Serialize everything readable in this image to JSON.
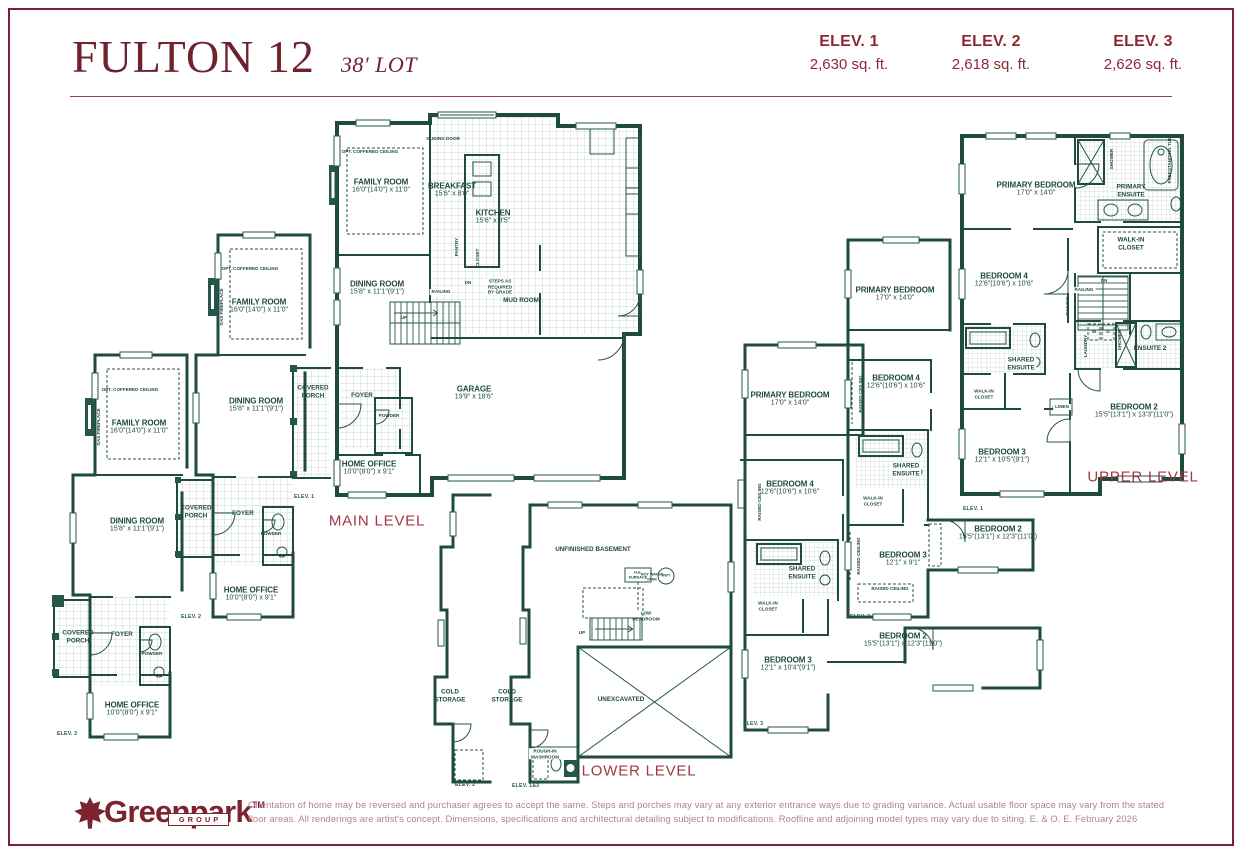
{
  "header": {
    "title": "FULTON 12",
    "lot": "38' LOT"
  },
  "elevations": [
    {
      "label": "ELEV. 1",
      "area": "2,630 sq. ft."
    },
    {
      "label": "ELEV. 2",
      "area": "2,618 sq. ft."
    },
    {
      "label": "ELEV. 3",
      "area": "2,626 sq. ft."
    }
  ],
  "levels": {
    "main": "MAIN LEVEL",
    "lower": "LOWER LEVEL",
    "upper": "UPPER LEVEL"
  },
  "rooms": {
    "family": {
      "name": "FAMILY ROOM",
      "dim": "16'0\"(14'0\") x 11'0\""
    },
    "breakfast": {
      "name": "BREAKFAST",
      "dim": "15'6\" x 8'0\""
    },
    "kitchen": {
      "name": "KITCHEN",
      "dim": "15'6\" x 8'5\""
    },
    "dining": {
      "name": "DINING ROOM",
      "dim": "15'8\" x 11'1\"(9'1\")"
    },
    "garage": {
      "name": "GARAGE",
      "dim": "19'9\" x 18'6\""
    },
    "home_office": {
      "name": "HOME OFFICE",
      "dim": "10'0\"(8'0\") x 9'1\""
    },
    "primary": {
      "name": "PRIMARY BEDROOM",
      "dim": "17'0\" x 14'0\""
    },
    "bedroom4": {
      "name": "BEDROOM 4",
      "dim": "12'6\"(10'6\") x 10'6\""
    },
    "bedroom3_e1": {
      "name": "BEDROOM 3",
      "dim": "12'1\" x 10'5\"(9'1\")"
    },
    "bedroom3_e2": {
      "name": "BEDROOM 3",
      "dim": "12'1\" x 9'1\""
    },
    "bedroom3_e3": {
      "name": "BEDROOM 3",
      "dim": "12'1\" x 10'4\"(9'1\")"
    },
    "bedroom2_e1": {
      "name": "BEDROOM 2",
      "dim": "15'5\"(13'1\") x 13'3\"(11'0\")"
    },
    "bedroom2_e23": {
      "name": "BEDROOM 2",
      "dim": "15'5\"(13'1\") x 12'3\"(11'0\")"
    }
  },
  "labels": {
    "covered_porch": "COVERED\nPORCH",
    "foyer": "FOYER",
    "powder": "POWDER",
    "mud_room": "MUD ROOM",
    "pantry": "PANTRY",
    "closet": "CLOSET",
    "sliding_door": "SLIDING DOOR",
    "opt_coffered": "OPT. COFFERED CEILING",
    "gas_fireplace": "GAS FIREPLACE",
    "railing": "RAILING",
    "up": "UP",
    "dn": "DN",
    "steps_grade": "STEPS AS\nREQUIRED\nBY GRADE",
    "unfinished": "UNFINISHED BASEMENT",
    "cold_storage": "COLD\nSTORAGE",
    "unexcavated": "UNEXCAVATED",
    "he_furnace": "H.E.\nFURNACE",
    "hot_water": "HOT WATER\nTANK",
    "hwt": "HWT",
    "low_headroom": "LOW\nHEADROOM",
    "rough_in": "ROUGH-IN\nWASHROOM",
    "primary_ensuite": "PRIMARY\nENSUITE",
    "walk_in": "WALK-IN\nCLOSET",
    "shared_ensuite": "SHARED\nENSUITE",
    "ensuite2": "ENSUITE 2",
    "laundry": "LAUNDRY",
    "linen": "LINEN",
    "shower": "SHOWER",
    "freestanding_tub": "FREESTANDING TUB",
    "raised_ceiling": "RAISED CEILING",
    "washer": "W",
    "dryer": "D"
  },
  "tags": {
    "e1": "ELEV. 1",
    "e2": "ELEV. 2",
    "e3": "ELEV. 3",
    "e13": "ELEV. 1&3"
  },
  "footer": {
    "brand": "Greenpark",
    "tm": "TM",
    "group": "GROUP",
    "disclaimer": "Orientation of home may be reversed and purchaser agrees to accept the same. Steps and porches may vary at any exterior entrance ways due to grading variance. Actual usable floor space may vary from the stated\nfloor areas. All renderings are artist's concept. Dimensions, specifications and architectural detailing subject to modifications. Roofline and adjoining model types may vary due to siting. E. & O. E. February 2026"
  },
  "colors": {
    "maroon": "#7b2230",
    "plan_teal": "#1f4a40",
    "level_red": "#a33744",
    "disclaimer": "#b2838a"
  }
}
